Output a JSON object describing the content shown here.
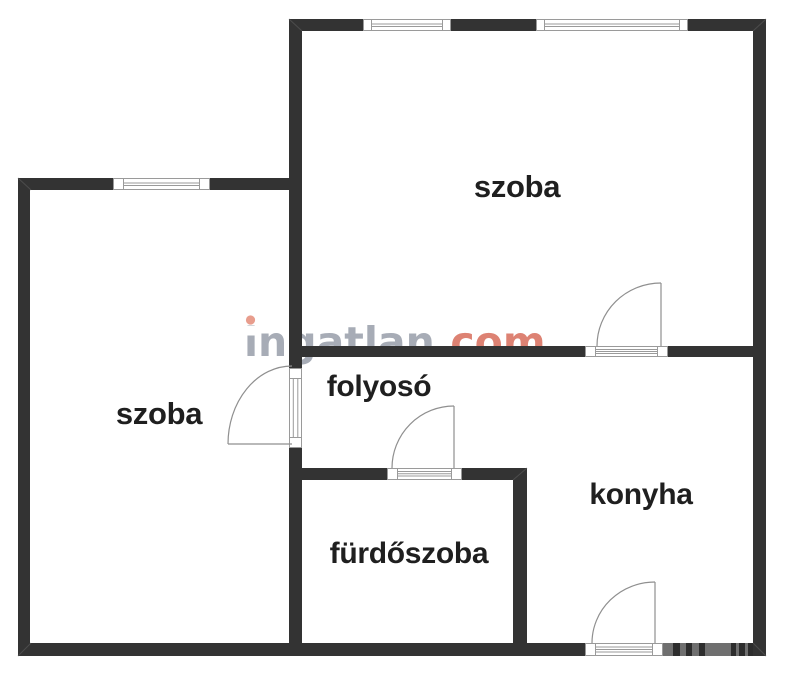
{
  "page": {
    "width": 786,
    "height": 675,
    "background": "#ffffff"
  },
  "watermark": {
    "full": "ingatlan.com",
    "part_gray": "ingatlan",
    "part_red": ".com"
  },
  "rooms": {
    "szoba_top": {
      "label": "szoba"
    },
    "szoba_left": {
      "label": "szoba"
    },
    "folyoso": {
      "label": "folyosó"
    },
    "konyha": {
      "label": "konyha"
    },
    "furdoszoba": {
      "label": "fürdőszoba"
    }
  },
  "fixtures": {
    "window_count": 3,
    "door_count": 4
  },
  "colors": {
    "background": "#ffffff",
    "wall": "#333333",
    "label": "#1f1f1f",
    "fixture-line": "#9a9a9a",
    "door-line": "#8f8f8f",
    "seam": "#555555",
    "watermark-gray": "#a7acb6",
    "watermark-red": "#dd8273",
    "watermark-dot": "#e89d8d",
    "corner-band": "#6f6f6f",
    "corner-bar": "#2d2d2d"
  }
}
